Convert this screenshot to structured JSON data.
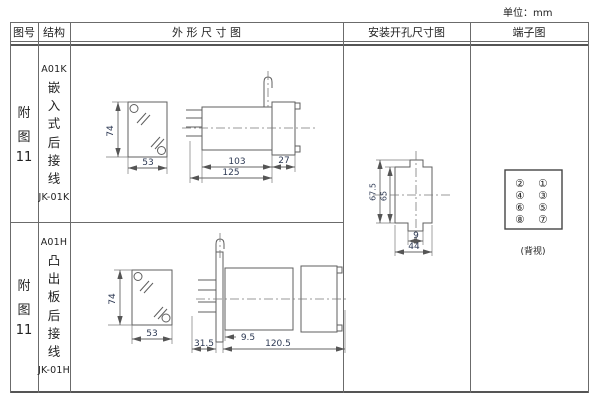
{
  "page": {
    "unit_label": "单位：mm"
  },
  "table": {
    "headers": [
      "图号",
      "结构",
      "外 形 尺 寸 图",
      "安装开孔尺寸图",
      "端子图"
    ],
    "rows": [
      {
        "fig_lines": [
          "附",
          "图",
          "11"
        ],
        "model": "A01K",
        "structure": "嵌入式后接线",
        "code": "JK-01K",
        "dims": {
          "front_height": "74",
          "front_width": "53",
          "body_depth": "103",
          "flange_depth": "27",
          "total_depth": "125"
        }
      },
      {
        "fig_lines": [
          "附",
          "图",
          "11"
        ],
        "model": "A01H",
        "structure": "凸出板后接线",
        "code": "JK-01H",
        "dims": {
          "front_height": "74",
          "front_width": "53",
          "plate_offset": "9.5",
          "rear_depth": "31.5",
          "total_depth": "120.5"
        }
      }
    ]
  },
  "install": {
    "outer_height": "67.5",
    "inner_height": "65",
    "notch_width": "9",
    "hole_width": "44"
  },
  "terminal": {
    "left_column": [
      "②",
      "④",
      "⑥",
      "⑧"
    ],
    "right_column": [
      "①",
      "③",
      "⑤",
      "⑦"
    ],
    "caption": "(背视)"
  },
  "colors": {
    "line": "#5f5f5f",
    "dim_text": "#2e3a54",
    "text": "#222222"
  }
}
